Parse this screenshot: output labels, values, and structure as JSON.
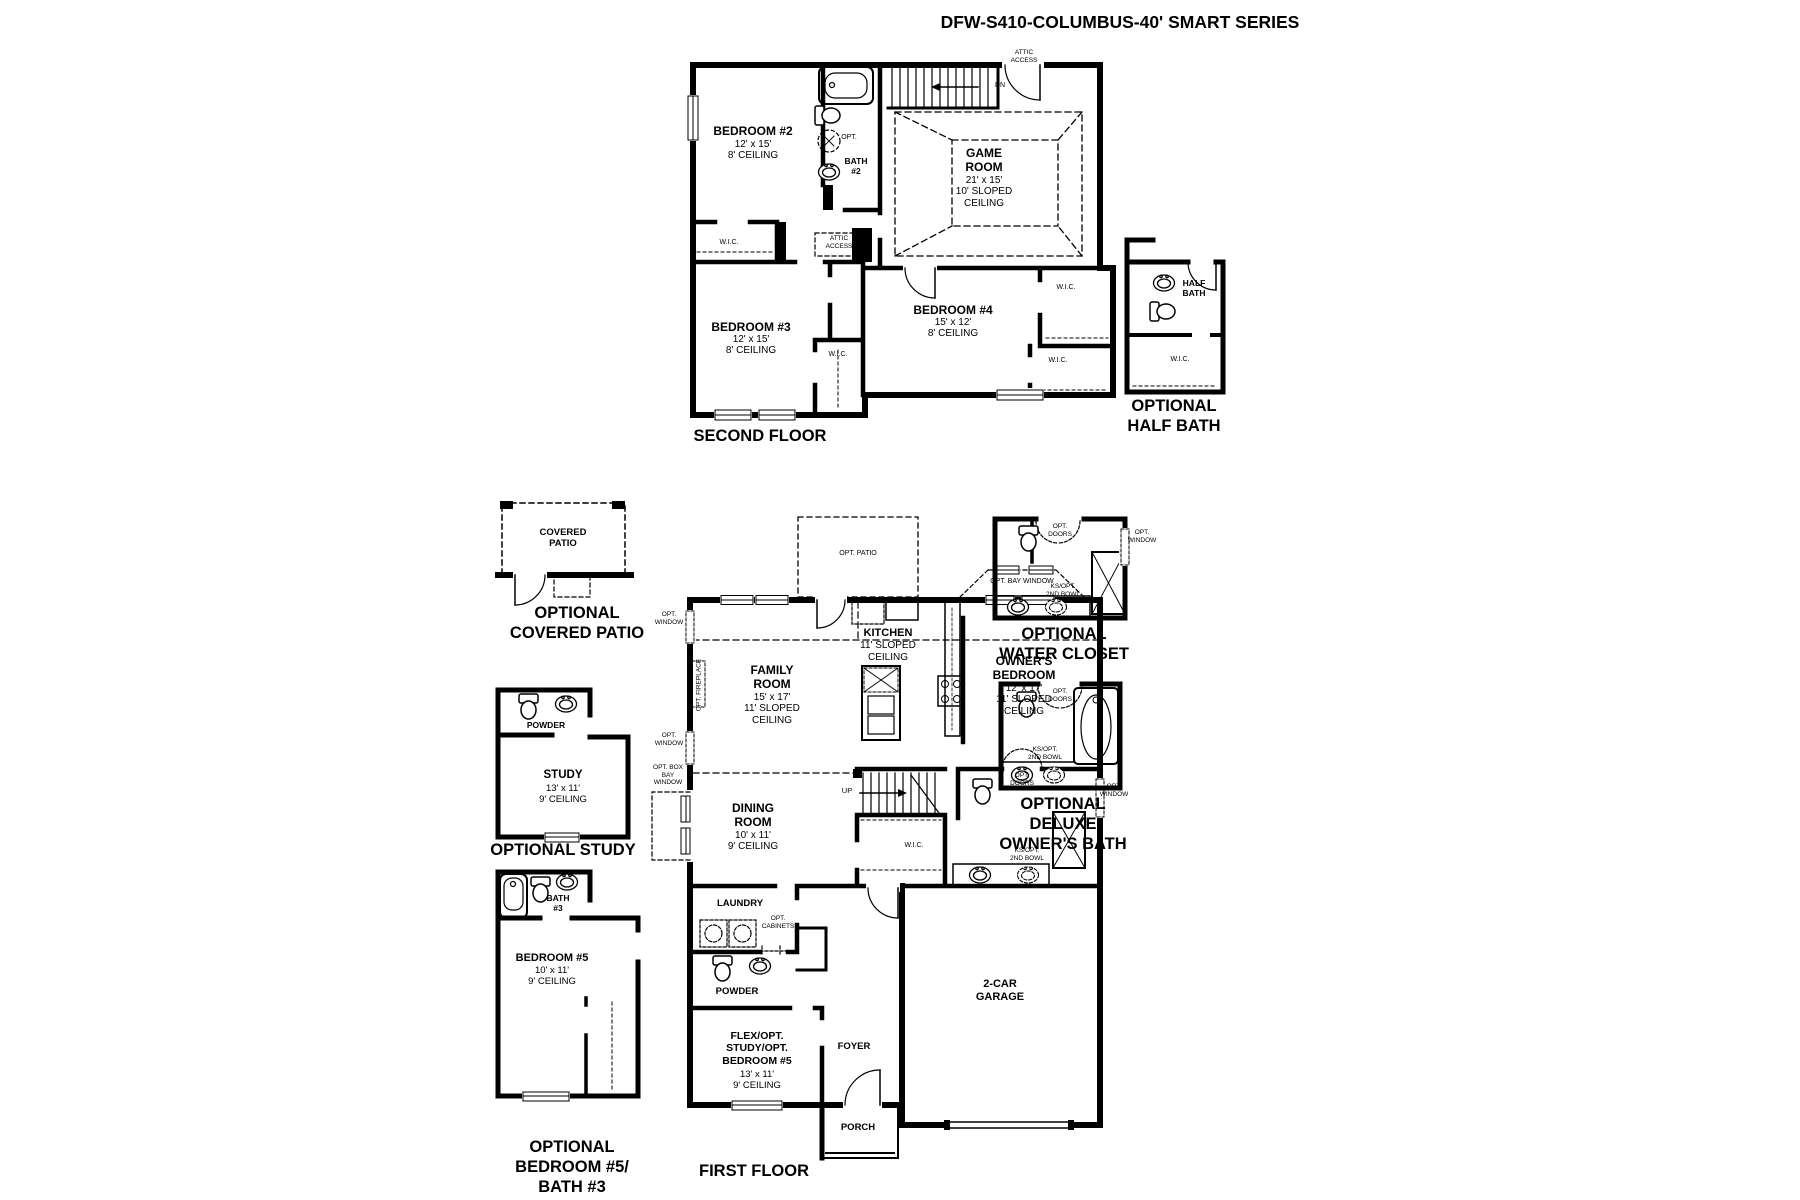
{
  "page": {
    "title": "DFW-S410-COLUMBUS-40' SMART SERIES"
  },
  "second_floor": {
    "floor_label": "SECOND FLOOR",
    "bedroom2_name": "BEDROOM #2",
    "bedroom2_dims": "12' x 15'",
    "bedroom2_ceiling": "8' CEILING",
    "bath2_name": "BATH\n#2",
    "bath2_opt": "OPT.",
    "stairs_dn": "DN",
    "attic_access_door": "ATTIC\nACCESS",
    "attic_access_panel": "ATTIC\nACCESS",
    "game_room_name": "GAME\nROOM",
    "game_room_dims": "21' x 15'",
    "game_room_ceiling": "10' SLOPED\nCEILING",
    "wic_hall": "W.I.C.",
    "bedroom3_name": "BEDROOM #3",
    "bedroom3_dims": "12' x 15'",
    "bedroom3_ceiling": "8' CEILING",
    "bedroom3_wic": "W.I.C.",
    "bedroom4_name": "BEDROOM #4",
    "bedroom4_dims": "15' x 12'",
    "bedroom4_ceiling": "8' CEILING",
    "wic_right_upper": "W.I.C.",
    "wic_right_lower": "W.I.C."
  },
  "optional_half_bath": {
    "room_name": "HALF\nBATH",
    "wic": "W.I.C.",
    "section_label": "OPTIONAL\nHALF BATH"
  },
  "optional_covered_patio": {
    "room_name": "COVERED\nPATIO",
    "section_label": "OPTIONAL\nCOVERED PATIO"
  },
  "first_floor": {
    "floor_label": "FIRST FLOOR",
    "opt_patio": "OPT. PATIO",
    "opt_window_upper": "OPT.\nWINDOW",
    "opt_window_lower": "OPT.\nWINDOW",
    "opt_fireplace": "OPT. FIREPLACE",
    "opt_box_bay_window": "OPT. BOX\nBAY\nWINDOW",
    "family_room_name": "FAMILY\nROOM",
    "family_room_dims": "15' x 17'",
    "family_room_ceiling": "11' SLOPED\nCEILING",
    "kitchen_name": "KITCHEN",
    "kitchen_ceiling": "11' SLOPED\nCEILING",
    "opt_bay_window": "OPT. BAY WINDOW",
    "owners_bedroom_name": "OWNER'S\nBEDROOM",
    "owners_bedroom_dims": "12' x 17'",
    "owners_bedroom_ceiling": "11' SLOPED\nCEILING",
    "dining_room_name": "DINING\nROOM",
    "dining_room_dims": "10' x 11'",
    "dining_room_ceiling": "9' CEILING",
    "stairs_up": "UP",
    "owners_wic": "W.I.C.",
    "opt_doors": "OPT.\nDOORS",
    "opt_window_bath": "OPT.\nWINDOW",
    "ks_opt_2nd_bowl": "KS/OPT.\n2ND BOWL",
    "laundry": "LAUNDRY",
    "opt_cabinets": "OPT.\nCABINETS",
    "powder": "POWDER",
    "flex_name": "FLEX/OPT.\nSTUDY/OPT.\nBEDROOM #5",
    "flex_dims": "13' x 11'",
    "flex_ceiling": "9' CEILING",
    "foyer": "FOYER",
    "porch": "PORCH",
    "garage": "2-CAR\nGARAGE"
  },
  "optional_water_closet": {
    "opt_doors": "OPT.\nDOORS",
    "opt_window": "OPT.\nWINDOW",
    "ks_opt_2nd_bowl": "KS/OPT.\n2ND BOWL",
    "section_label": "OPTIONAL\nWATER CLOSET"
  },
  "optional_deluxe_owners_bath": {
    "opt_doors": "OPT.\nDOORS",
    "ks_opt_2nd_bowl": "KS/OPT.\n2ND BOWL",
    "section_label": "OPTIONAL\nDELUXE\nOWNER'S BATH"
  },
  "optional_study": {
    "powder": "POWDER",
    "study_name": "STUDY",
    "study_dims": "13' x 11'",
    "study_ceiling": "9' CEILING",
    "section_label": "OPTIONAL STUDY"
  },
  "optional_bedroom5_bath3": {
    "bath3_name": "BATH\n#3",
    "bedroom5_name": "BEDROOM #5",
    "bedroom5_dims": "10' x 11'",
    "bedroom5_ceiling": "9' CEILING",
    "section_label": "OPTIONAL\nBEDROOM #5/\nBATH #3"
  },
  "colors": {
    "ink": "#000000",
    "paper": "#ffffff"
  }
}
